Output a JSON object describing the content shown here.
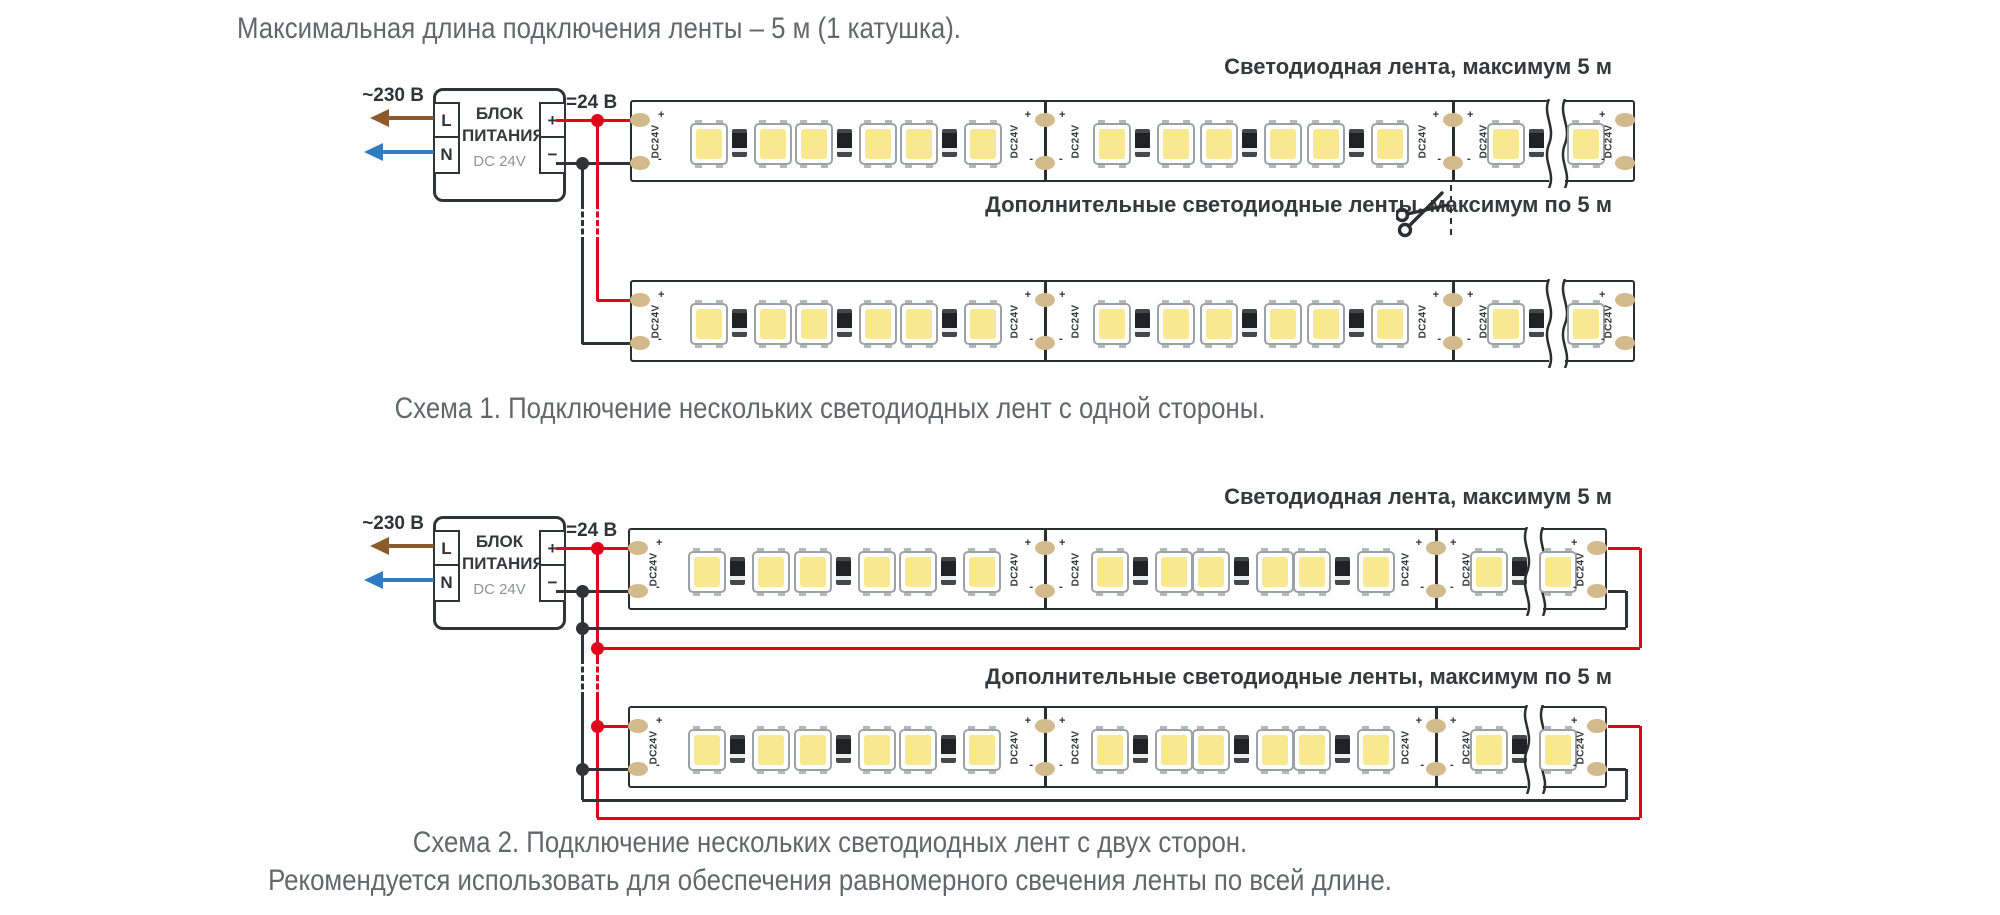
{
  "title": "Максимальная длина подключения ленты – 5 м (1 катушка).",
  "psu": {
    "name_line1": "БЛОК",
    "name_line2": "ПИТАНИЯ",
    "model": "DC 24V",
    "terminal_l": "L",
    "terminal_n": "N",
    "terminal_plus": "+",
    "terminal_minus": "−",
    "input_label": "~230 В",
    "output_label": "=24 В"
  },
  "strip": {
    "dc_label": "DC24V",
    "plus_mark": "+",
    "minus_mark": "-"
  },
  "scheme1": {
    "main_strip_label": "Светодиодная лента, максимум 5 м",
    "additional_strips_label": "Дополнительные светодиодные ленты, максимум по 5 м",
    "caption": "Схема 1. Подключение нескольких светодиодных лент с одной стороны."
  },
  "scheme2": {
    "main_strip_label": "Светодиодная лента, максимум 5 м",
    "additional_strips_label": "Дополнительные светодиодные ленты, максимум по 5 м",
    "caption": "Схема 2. Подключение нескольких светодиодных лент с двух сторон.",
    "note": "Рекомендуется использовать для обеспечения равномерного свечения ленты по всей длине."
  },
  "icons": {
    "scissors": "✂"
  },
  "colors": {
    "wire_red": "#e2001a",
    "wire_dark": "#303337",
    "pad": "#d3ba8c",
    "led": "#f8e88f",
    "arrow_brown": "#8a5a2b",
    "arrow_blue": "#2f7bc4"
  }
}
